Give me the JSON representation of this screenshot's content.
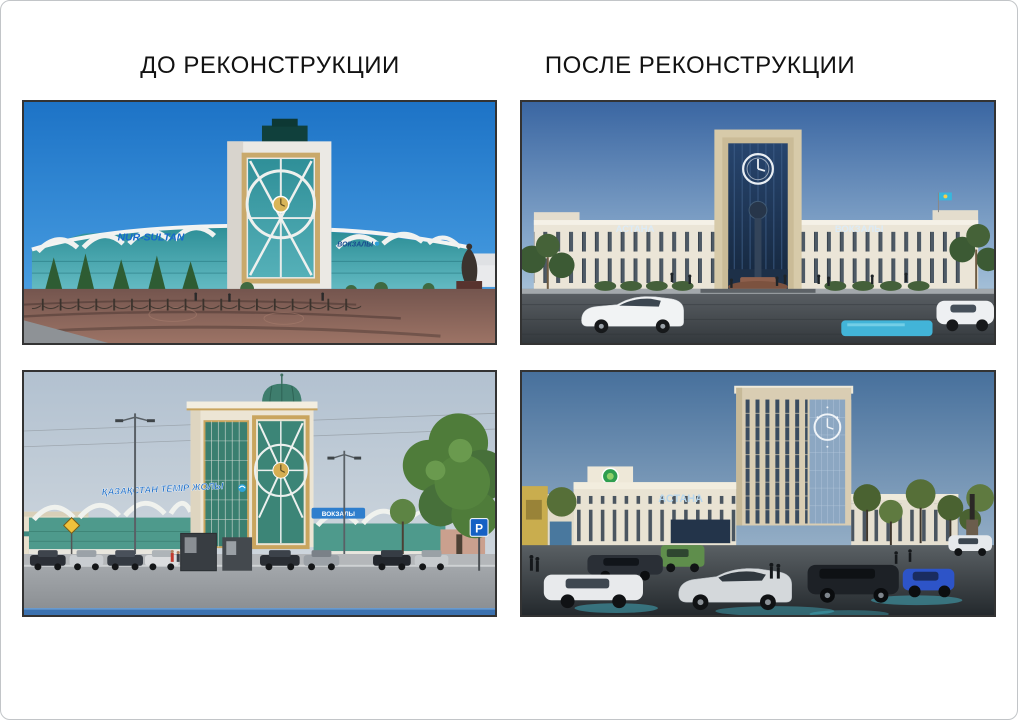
{
  "headers": {
    "before": "ДО РЕКОНСТРУКЦИИ",
    "after": "ПОСЛЕ РЕКОНСТРУКЦИИ"
  },
  "photos": {
    "nursultan_before": {
      "sign_left": "NUR-SULTAN",
      "sign_right": "ВОКЗАЛЫ"
    },
    "astana_after": {
      "sign_left": "АСТАНА",
      "sign_right": "ВОКЗАЛЫ"
    },
    "ktz_before": {
      "sign_roof": "ҚАЗАҚСТАН ТЕМІР ЖОЛЫ",
      "sign_right": "ВОКЗАЛЫ",
      "parking": "P"
    },
    "astana1_after": {
      "sign_left": "АСТАНА"
    }
  },
  "colors": {
    "header_text": "#121212",
    "page_border": "#c2c5c8",
    "photo_border": "#333333",
    "sign_blue": "#1668cc",
    "photo_sky_blue": "#1d73c6",
    "render_sky_blue": "#3a66a2",
    "glass_teal": "#2f8f98",
    "render_beige": "#d7caa9"
  }
}
